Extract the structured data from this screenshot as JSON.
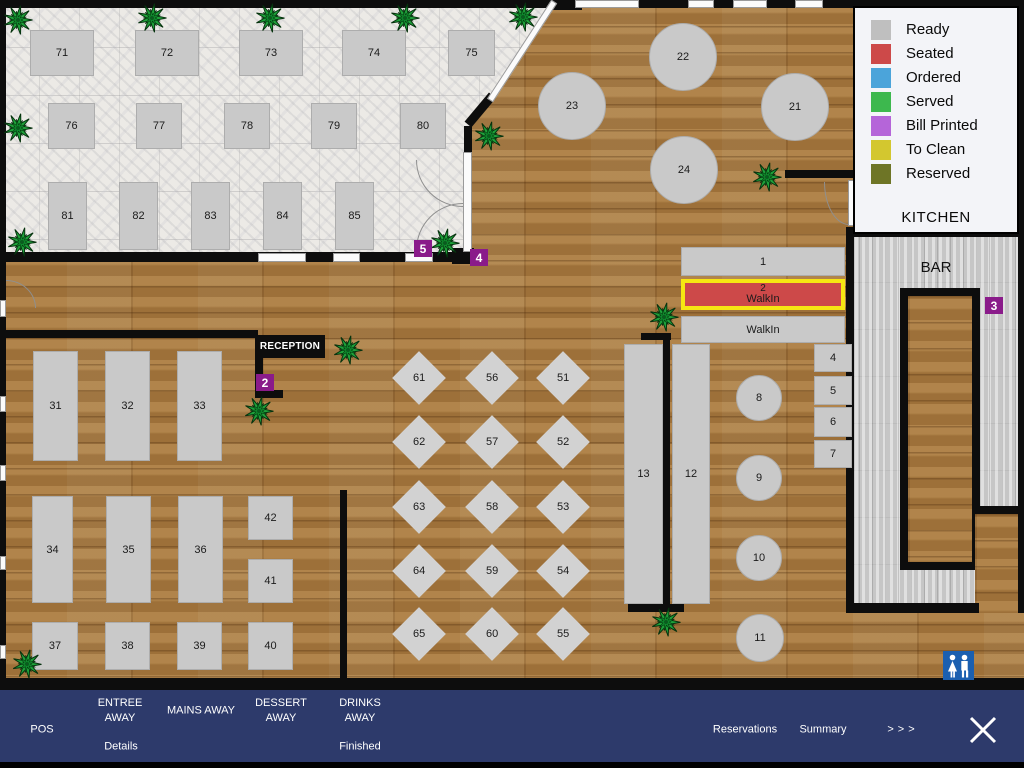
{
  "legend": {
    "kitchen_label": "KITCHEN",
    "items": [
      {
        "label": "Ready",
        "color": "#bfbfbf"
      },
      {
        "label": "Seated",
        "color": "#cd4949"
      },
      {
        "label": "Ordered",
        "color": "#4ba4da"
      },
      {
        "label": "Served",
        "color": "#3db84e"
      },
      {
        "label": "Bill Printed",
        "color": "#b565d9"
      },
      {
        "label": "To Clean",
        "color": "#d3c72f"
      },
      {
        "label": "Reserved",
        "color": "#6e7526"
      }
    ]
  },
  "areas": {
    "bar_label": "BAR",
    "reception_label": "RECEPTION"
  },
  "status_colors": {
    "ready": "#c9c9c9",
    "seated": "#cd4949"
  },
  "highlight_color": "#f6e612",
  "tables": {
    "rect": [
      {
        "id": "71",
        "x": 30,
        "y": 30,
        "w": 64,
        "h": 46
      },
      {
        "id": "72",
        "x": 135,
        "y": 30,
        "w": 64,
        "h": 46
      },
      {
        "id": "73",
        "x": 239,
        "y": 30,
        "w": 64,
        "h": 46
      },
      {
        "id": "74",
        "x": 342,
        "y": 30,
        "w": 64,
        "h": 46
      },
      {
        "id": "75",
        "x": 448,
        "y": 30,
        "w": 47,
        "h": 46
      },
      {
        "id": "76",
        "x": 48,
        "y": 103,
        "w": 47,
        "h": 46
      },
      {
        "id": "77",
        "x": 136,
        "y": 103,
        "w": 46,
        "h": 46
      },
      {
        "id": "78",
        "x": 224,
        "y": 103,
        "w": 46,
        "h": 46
      },
      {
        "id": "79",
        "x": 311,
        "y": 103,
        "w": 46,
        "h": 46
      },
      {
        "id": "80",
        "x": 400,
        "y": 103,
        "w": 46,
        "h": 46
      },
      {
        "id": "81",
        "x": 48,
        "y": 182,
        "w": 39,
        "h": 68
      },
      {
        "id": "82",
        "x": 119,
        "y": 182,
        "w": 39,
        "h": 68
      },
      {
        "id": "83",
        "x": 191,
        "y": 182,
        "w": 39,
        "h": 68
      },
      {
        "id": "84",
        "x": 263,
        "y": 182,
        "w": 39,
        "h": 68
      },
      {
        "id": "85",
        "x": 335,
        "y": 182,
        "w": 39,
        "h": 68
      },
      {
        "id": "1",
        "x": 681,
        "y": 247,
        "w": 164,
        "h": 29
      },
      {
        "id": "2",
        "label": "WalkIn",
        "sup": "2",
        "x": 681,
        "y": 279,
        "w": 164,
        "h": 31,
        "status": "seated",
        "highlight": true
      },
      {
        "id": "walkin",
        "label": "WalkIn",
        "x": 681,
        "y": 316,
        "w": 164,
        "h": 27
      },
      {
        "id": "4",
        "x": 814,
        "y": 344,
        "w": 38,
        "h": 28
      },
      {
        "id": "5",
        "x": 814,
        "y": 376,
        "w": 38,
        "h": 29
      },
      {
        "id": "6",
        "x": 814,
        "y": 407,
        "w": 38,
        "h": 30
      },
      {
        "id": "7",
        "x": 814,
        "y": 440,
        "w": 38,
        "h": 28
      },
      {
        "id": "13",
        "x": 624,
        "y": 344,
        "w": 39,
        "h": 260
      },
      {
        "id": "12",
        "x": 672,
        "y": 344,
        "w": 38,
        "h": 260
      },
      {
        "id": "31",
        "x": 33,
        "y": 351,
        "w": 45,
        "h": 110
      },
      {
        "id": "32",
        "x": 105,
        "y": 351,
        "w": 45,
        "h": 110
      },
      {
        "id": "33",
        "x": 177,
        "y": 351,
        "w": 45,
        "h": 110
      },
      {
        "id": "34",
        "x": 32,
        "y": 496,
        "w": 41,
        "h": 107
      },
      {
        "id": "35",
        "x": 106,
        "y": 496,
        "w": 45,
        "h": 107
      },
      {
        "id": "36",
        "x": 178,
        "y": 496,
        "w": 45,
        "h": 107
      },
      {
        "id": "42",
        "x": 248,
        "y": 496,
        "w": 45,
        "h": 44
      },
      {
        "id": "41",
        "x": 248,
        "y": 559,
        "w": 45,
        "h": 44
      },
      {
        "id": "37",
        "x": 32,
        "y": 622,
        "w": 46,
        "h": 48
      },
      {
        "id": "38",
        "x": 105,
        "y": 622,
        "w": 45,
        "h": 48
      },
      {
        "id": "39",
        "x": 177,
        "y": 622,
        "w": 45,
        "h": 48
      },
      {
        "id": "40",
        "x": 248,
        "y": 622,
        "w": 45,
        "h": 48
      }
    ],
    "round": [
      {
        "id": "22",
        "cx": 683,
        "cy": 57,
        "r": 34
      },
      {
        "id": "23",
        "cx": 572,
        "cy": 106,
        "r": 34
      },
      {
        "id": "21",
        "cx": 795,
        "cy": 107,
        "r": 34
      },
      {
        "id": "24",
        "cx": 684,
        "cy": 170,
        "r": 34
      },
      {
        "id": "8",
        "cx": 759,
        "cy": 398,
        "r": 23
      },
      {
        "id": "9",
        "cx": 759,
        "cy": 478,
        "r": 23
      },
      {
        "id": "10",
        "cx": 759,
        "cy": 558,
        "r": 23
      },
      {
        "id": "11",
        "cx": 760,
        "cy": 638,
        "r": 24
      }
    ],
    "diamond": [
      {
        "id": "61",
        "cx": 419,
        "cy": 378
      },
      {
        "id": "56",
        "cx": 492,
        "cy": 378
      },
      {
        "id": "51",
        "cx": 563,
        "cy": 378
      },
      {
        "id": "62",
        "cx": 419,
        "cy": 442
      },
      {
        "id": "57",
        "cx": 492,
        "cy": 442
      },
      {
        "id": "52",
        "cx": 563,
        "cy": 442
      },
      {
        "id": "63",
        "cx": 419,
        "cy": 507
      },
      {
        "id": "58",
        "cx": 492,
        "cy": 507
      },
      {
        "id": "53",
        "cx": 563,
        "cy": 507
      },
      {
        "id": "64",
        "cx": 419,
        "cy": 571
      },
      {
        "id": "59",
        "cx": 492,
        "cy": 571
      },
      {
        "id": "54",
        "cx": 563,
        "cy": 571
      },
      {
        "id": "65",
        "cx": 419,
        "cy": 634
      },
      {
        "id": "60",
        "cx": 492,
        "cy": 634
      },
      {
        "id": "55",
        "cx": 563,
        "cy": 634
      }
    ]
  },
  "door_markers": [
    {
      "label": "5",
      "x": 414,
      "y": 240
    },
    {
      "label": "4",
      "x": 470,
      "y": 249
    },
    {
      "label": "3",
      "x": 985,
      "y": 297
    },
    {
      "label": "2",
      "x": 256,
      "y": 374
    }
  ],
  "plants": [
    [
      3,
      5
    ],
    [
      137,
      3
    ],
    [
      255,
      3
    ],
    [
      390,
      3
    ],
    [
      508,
      2
    ],
    [
      3,
      113
    ],
    [
      7,
      227
    ],
    [
      474,
      121
    ],
    [
      430,
      228
    ],
    [
      752,
      162
    ],
    [
      649,
      302
    ],
    [
      333,
      335
    ],
    [
      244,
      396
    ],
    [
      651,
      607
    ],
    [
      12,
      649
    ]
  ],
  "nav": {
    "pos": "POS",
    "entree": "ENTREE\nAWAY",
    "details": "Details",
    "mains": "MAINS AWAY",
    "dessert": "DESSERT\nAWAY",
    "drinks": "DRINKS\nAWAY",
    "finished": "Finished",
    "reservations": "Reservations",
    "summary": "Summary",
    "more": ">>>"
  }
}
